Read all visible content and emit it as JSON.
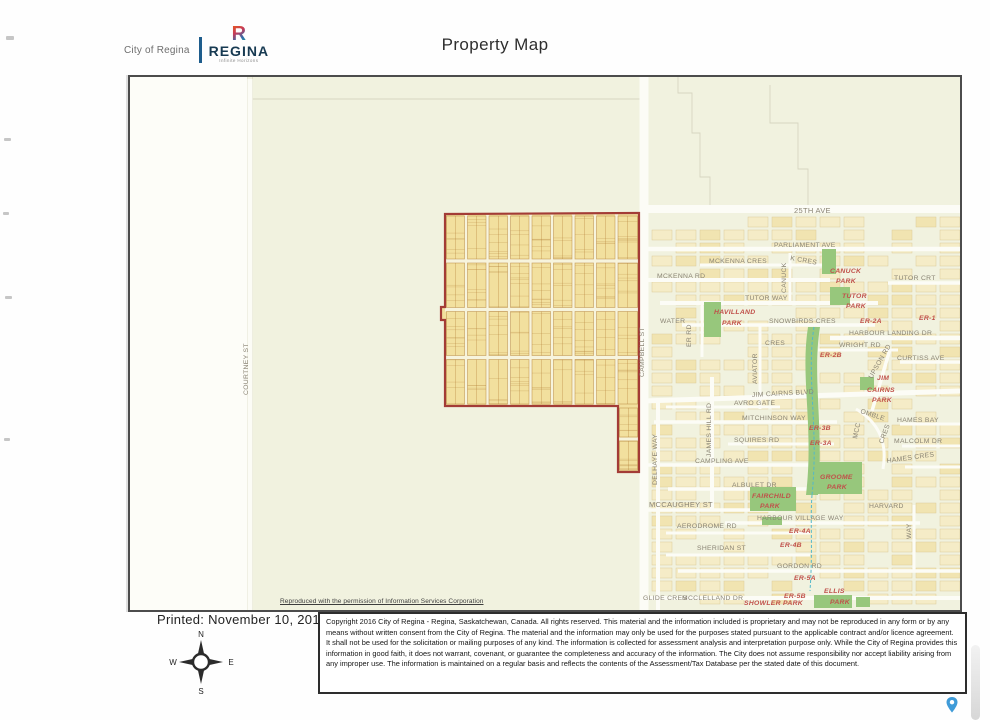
{
  "header": {
    "org": "City of Regina",
    "logo_r": "R",
    "logo_name": "REGINA",
    "logo_tagline": "Infinite Horizons",
    "title": "Property Map"
  },
  "map": {
    "permission_note": "Reproduced with the permission of Information Services Corporation",
    "street_labels": [
      {
        "t": "25TH AVE",
        "x": 664,
        "y": 136,
        "s": 7.5
      },
      {
        "t": "PARLIAMENT AVE",
        "x": 644,
        "y": 170
      },
      {
        "t": "MCKENNA CRES",
        "x": 579,
        "y": 186
      },
      {
        "t": "K CRES",
        "x": 660,
        "y": 183,
        "r": 10
      },
      {
        "t": "MCKENNA RD",
        "x": 527,
        "y": 201
      },
      {
        "t": "CANUCK",
        "x": 656,
        "y": 216,
        "r": -90
      },
      {
        "t": "TUTOR CRT",
        "x": 764,
        "y": 203
      },
      {
        "t": "TUTOR WAY",
        "x": 615,
        "y": 223
      },
      {
        "t": "WATER",
        "x": 530,
        "y": 246
      },
      {
        "t": "ER RD",
        "x": 561,
        "y": 270,
        "r": -90
      },
      {
        "t": "SNOWBIRDS CRES",
        "x": 639,
        "y": 246
      },
      {
        "t": "HARBOUR LANDING DR",
        "x": 719,
        "y": 258
      },
      {
        "t": "CRES",
        "x": 635,
        "y": 268
      },
      {
        "t": "WRIGHT RD",
        "x": 709,
        "y": 270
      },
      {
        "t": "CURTISS AVE",
        "x": 767,
        "y": 283
      },
      {
        "t": "UPSON RD",
        "x": 742,
        "y": 302,
        "r": -60
      },
      {
        "t": "AVIATOR",
        "x": 627,
        "y": 307,
        "r": -90
      },
      {
        "t": "JIM CAIRNS BLVD",
        "x": 622,
        "y": 320,
        "r": -3
      },
      {
        "t": "AVRO GATE",
        "x": 604,
        "y": 328
      },
      {
        "t": "OMBLE",
        "x": 730,
        "y": 336,
        "r": 18
      },
      {
        "t": "MITCHINSON WAY",
        "x": 612,
        "y": 343
      },
      {
        "t": "MCC",
        "x": 727,
        "y": 362,
        "r": -78
      },
      {
        "t": "CRES",
        "x": 753,
        "y": 367,
        "r": -70
      },
      {
        "t": "HAMES BAY",
        "x": 767,
        "y": 345
      },
      {
        "t": "JAMES HILL RD",
        "x": 581,
        "y": 380,
        "r": -90
      },
      {
        "t": "DELHAYE WAY",
        "x": 527,
        "y": 408,
        "r": -90
      },
      {
        "t": "SQUIRES RD",
        "x": 604,
        "y": 365
      },
      {
        "t": "MALCOLM DR",
        "x": 764,
        "y": 366
      },
      {
        "t": "CAMPLING AVE",
        "x": 565,
        "y": 386
      },
      {
        "t": "HAMES CRES",
        "x": 757,
        "y": 386,
        "r": -8
      },
      {
        "t": "ALBULET DR",
        "x": 602,
        "y": 410
      },
      {
        "t": "MCCAUGHEY ST",
        "x": 519,
        "y": 430,
        "s": 7.5
      },
      {
        "t": "HARVARD",
        "x": 739,
        "y": 431
      },
      {
        "t": "WAY",
        "x": 781,
        "y": 462,
        "r": -90
      },
      {
        "t": "HARBOUR VILLAGE WAY",
        "x": 627,
        "y": 443
      },
      {
        "t": "AERODROME RD",
        "x": 547,
        "y": 451
      },
      {
        "t": "SHERIDAN ST",
        "x": 567,
        "y": 473
      },
      {
        "t": "GORDON RD",
        "x": 647,
        "y": 491
      },
      {
        "t": "GLIDE CRES",
        "x": 513,
        "y": 523
      },
      {
        "t": "MCCLELLAND DR",
        "x": 552,
        "y": 523
      },
      {
        "t": "CAMPBELL ST",
        "x": 514,
        "y": 300,
        "r": -90
      },
      {
        "t": "COURTNEY ST",
        "x": 118,
        "y": 318,
        "r": -90
      }
    ],
    "area_labels": [
      {
        "t": "CANUCK",
        "x": 700,
        "y": 196
      },
      {
        "t": "PARK",
        "x": 706,
        "y": 206
      },
      {
        "t": "TUTOR",
        "x": 712,
        "y": 221
      },
      {
        "t": "PARK",
        "x": 716,
        "y": 231
      },
      {
        "t": "HAVILLAND",
        "x": 584,
        "y": 237
      },
      {
        "t": "PARK",
        "x": 592,
        "y": 248
      },
      {
        "t": "ER-2A",
        "x": 730,
        "y": 246
      },
      {
        "t": "ER-1",
        "x": 789,
        "y": 243
      },
      {
        "t": "ER-2B",
        "x": 690,
        "y": 280
      },
      {
        "t": "JIM",
        "x": 747,
        "y": 303
      },
      {
        "t": "CAIRNS",
        "x": 737,
        "y": 315
      },
      {
        "t": "PARK",
        "x": 742,
        "y": 325
      },
      {
        "t": "ER-3B",
        "x": 679,
        "y": 353
      },
      {
        "t": "ER-3A",
        "x": 680,
        "y": 368
      },
      {
        "t": "GROOME",
        "x": 690,
        "y": 402
      },
      {
        "t": "PARK",
        "x": 697,
        "y": 412
      },
      {
        "t": "FAIRCHILD",
        "x": 622,
        "y": 421
      },
      {
        "t": "PARK",
        "x": 630,
        "y": 431
      },
      {
        "t": "ER-4A",
        "x": 659,
        "y": 456
      },
      {
        "t": "ER-4B",
        "x": 650,
        "y": 470
      },
      {
        "t": "ER-5A",
        "x": 664,
        "y": 503
      },
      {
        "t": "ER-5B",
        "x": 654,
        "y": 521
      },
      {
        "t": "ELLIS",
        "x": 694,
        "y": 516
      },
      {
        "t": "PARK",
        "x": 700,
        "y": 527
      },
      {
        "t": "SHOWLER PARK",
        "x": 614,
        "y": 528
      }
    ]
  },
  "footer": {
    "printed": "Printed: November 10, 2019",
    "compass": {
      "n": "N",
      "e": "E",
      "s": "S",
      "w": "W"
    },
    "copyright": "Copyright 2016 City of Regina - Regina, Saskatchewan, Canada. All rights reserved. This material and the information included is proprietary and may not be reproduced in any form or by any means without written consent from the City of Regina. The material and the information may only be used for the purposes stated pursuant to the applicable contract and/or licence agreement. It shall not be used for the solicitation or mailing purposes of any kind. The information is collected for assessment analysis and interpretation purpose only. While the City of Regina provides this information in good faith, it does not warrant, covenant, or guarantee the completeness and accuracy of the information. The City does not assume responsibility nor accept liability arising from any improper use. The information is maintained on a regular basis and reflects the contents of the Assessment/Tax Database per the stated date of this document."
  },
  "colors": {
    "property_outline_red": "#a33c36",
    "parcel_yellow": "#f2e09e",
    "park_green": "#97c77c",
    "drainage_teal": "#53b8c9",
    "map_cream": "#f1f2df",
    "street_label_gray": "#8a8474",
    "area_label_red": "#c0504a",
    "pin_blue": "#3f9bd8"
  }
}
